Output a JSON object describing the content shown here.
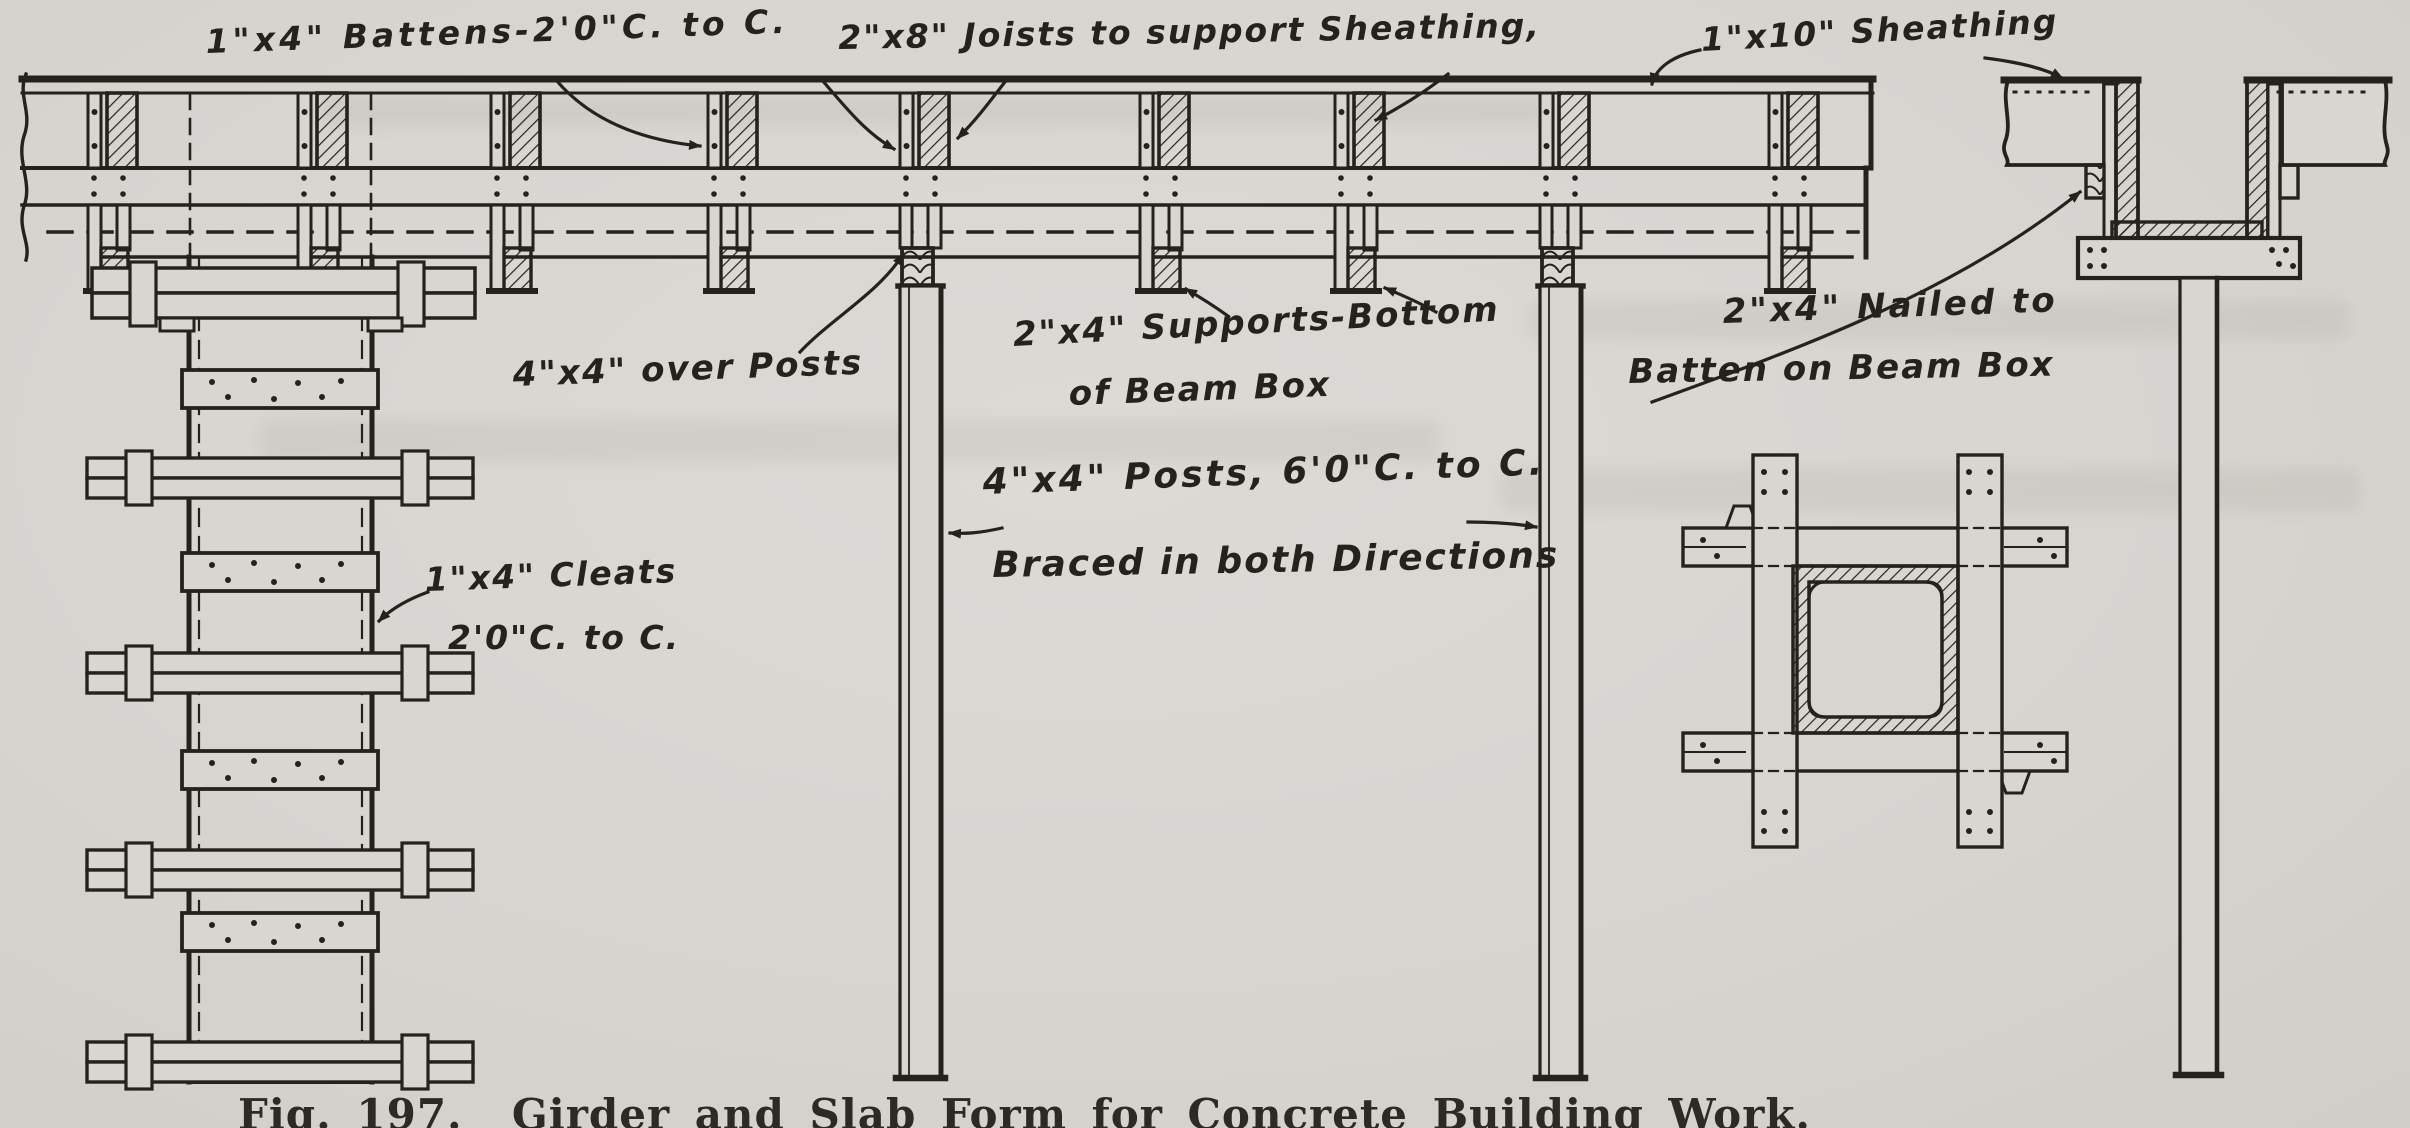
{
  "figure": {
    "caption": "Fig. 197.  Girder and Slab Form for Concrete Building Work.",
    "ink_color": "#24221d",
    "paper_color": "#d8d6d1",
    "labels": {
      "battens": "1\"x4\" Battens-2'0\"C. to C.",
      "joists": "2\"x8\" Joists to support Sheathing,",
      "sheathing": "1\"x10\" Sheathing",
      "over_posts": "4\"x4\" over Posts",
      "supports_line1": "2\"x4\" Supports-Bottom",
      "supports_line2": "of Beam Box",
      "nailed_line1": "2\"x4\" Nailed to",
      "nailed_line2": "Batten on Beam Box",
      "posts_line1": "4\"x4\" Posts, 6'0\"C. to C.",
      "posts_line2": "Braced in both Directions",
      "cleats_line1": "1\"x4\" Cleats",
      "cleats_line2": "2'0\"C. to C."
    }
  }
}
